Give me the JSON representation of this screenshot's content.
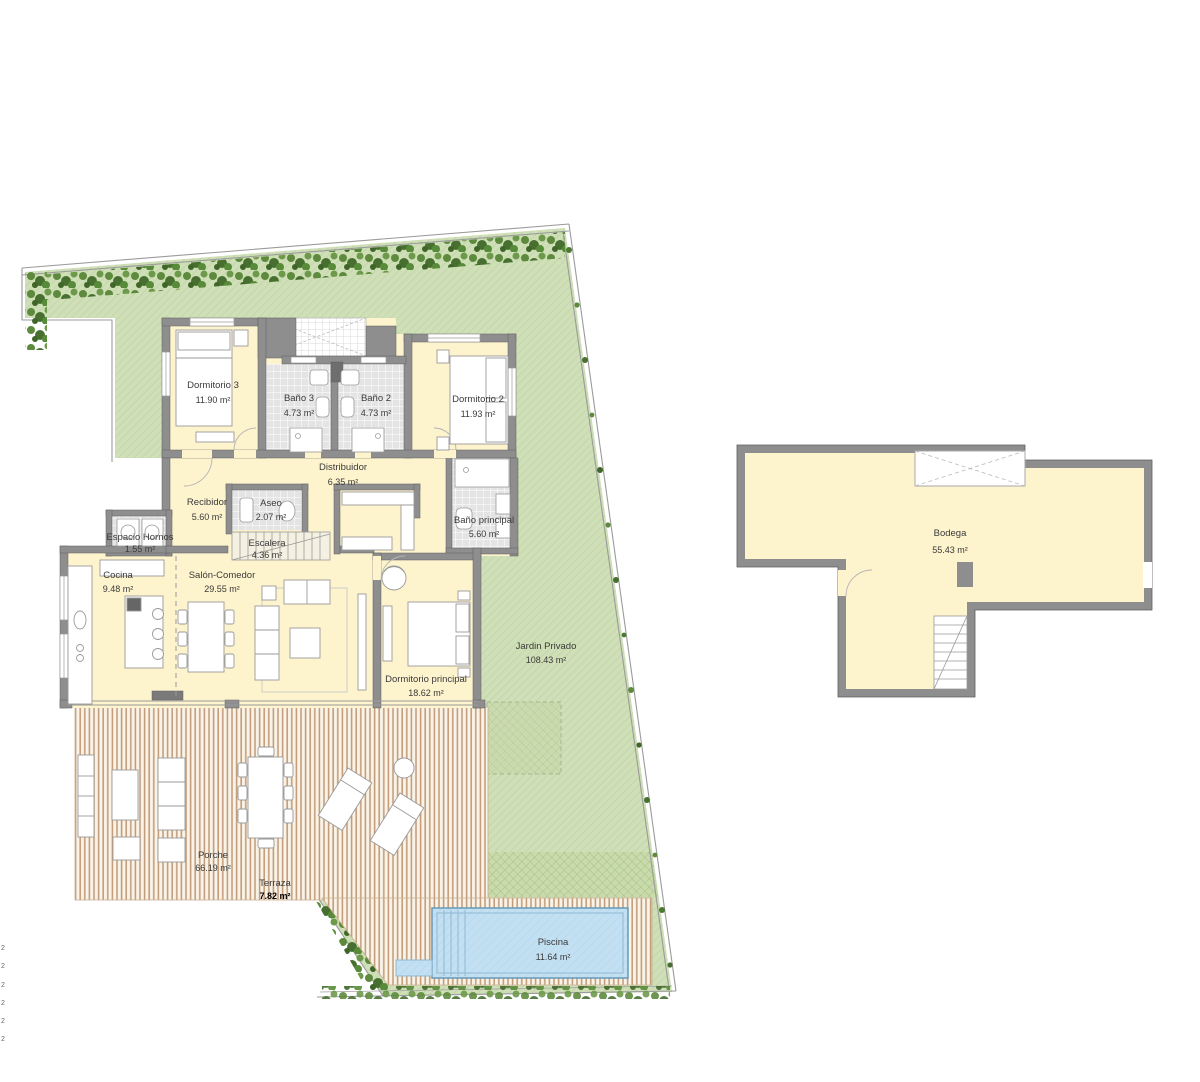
{
  "plan": {
    "rooms": [
      {
        "name": "Dormitorio 3",
        "area": "11.90 m²"
      },
      {
        "name": "Baño 3",
        "area": "4.73 m²"
      },
      {
        "name": "Baño 2",
        "area": "4.73 m²"
      },
      {
        "name": "Dormitorio 2",
        "area": "11.93 m²"
      },
      {
        "name": "Distribuidor",
        "area": "6.35 m²"
      },
      {
        "name": "Recibidor",
        "area": "5.60 m²"
      },
      {
        "name": "Aseo",
        "area": "2.07 m²"
      },
      {
        "name": "Baño principal",
        "area": "5.60 m²"
      },
      {
        "name": "Espacio Hornos",
        "area": "1.55 m²"
      },
      {
        "name": "Escalera",
        "area": "4.36 m²"
      },
      {
        "name": "Cocina",
        "area": "9.48 m²"
      },
      {
        "name": "Salón-Comedor",
        "area": "29.55 m²"
      },
      {
        "name": "Dormitorio principal",
        "area": "18.62 m²"
      },
      {
        "name": "Jardin Privado",
        "area": "108.43 m²"
      },
      {
        "name": "Porche",
        "area": "66.19 m²"
      },
      {
        "name": "Terraza",
        "area": "7.82 m²"
      },
      {
        "name": "Piscina",
        "area": "11.64 m²"
      },
      {
        "name": "Bodega",
        "area": "55.43 m²"
      }
    ],
    "edge_marks": [
      "2",
      "2",
      "2",
      "2",
      "2",
      "2"
    ],
    "colors": {
      "room_fill": "#fdf3cd",
      "garden": "#cfdfb7",
      "wall": "#8e8e8e",
      "pool_water": "#c3e0f2",
      "deck_stripe": "#c49e7c",
      "hedge": "#4a7a2e"
    }
  }
}
